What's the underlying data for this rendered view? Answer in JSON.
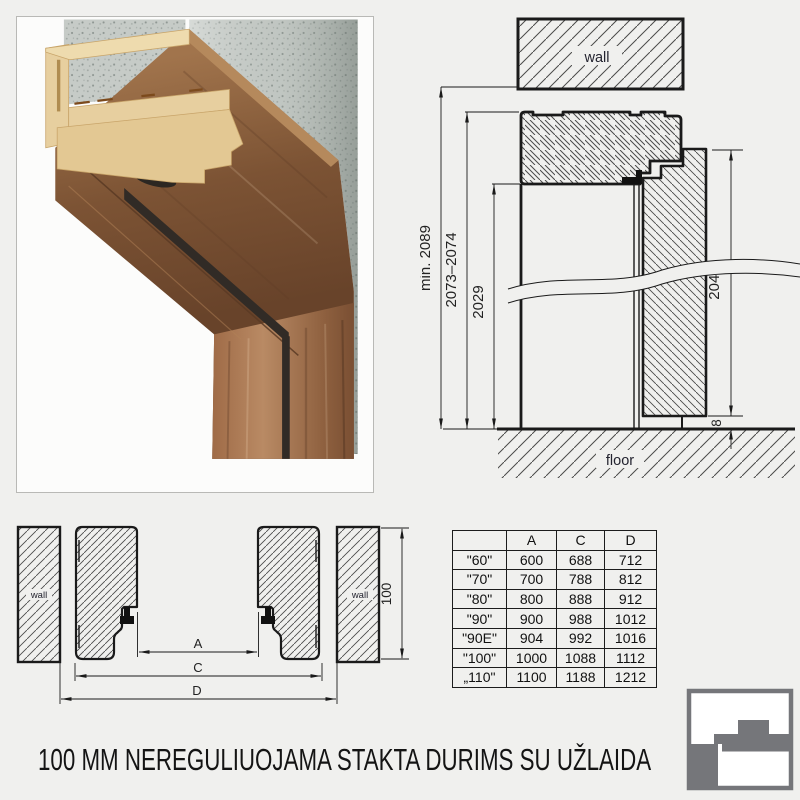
{
  "page": {
    "title": "100 MM NEREGULIUOJAMA STAKTA DURIMS SU UŽLAIDA",
    "background": "#f0f0ee"
  },
  "vertical_section": {
    "wall_label": "wall",
    "floor_label": "floor",
    "dims": {
      "min_total": "min. 2089",
      "frame_height": "2073–2074",
      "opening_height": "2029",
      "leaf_height": "2043",
      "floor_gap": "8"
    }
  },
  "horizontal_section": {
    "wall_left": "wall",
    "wall_right": "wall",
    "dims": {
      "a": "A",
      "c": "C",
      "d": "D",
      "depth": "100"
    }
  },
  "size_table": {
    "headers": [
      "",
      "A",
      "C",
      "D"
    ],
    "rows": [
      {
        "name": "\"60\"",
        "a": "600",
        "c": "688",
        "d": "712"
      },
      {
        "name": "\"70\"",
        "a": "700",
        "c": "788",
        "d": "812"
      },
      {
        "name": "\"80\"",
        "a": "800",
        "c": "888",
        "d": "912"
      },
      {
        "name": "\"90\"",
        "a": "900",
        "c": "988",
        "d": "1012"
      },
      {
        "name": "\"90E\"",
        "a": "904",
        "c": "992",
        "d": "1016"
      },
      {
        "name": "\"100\"",
        "a": "1000",
        "c": "1088",
        "d": "1112"
      },
      {
        "name": "„110\"",
        "a": "1100",
        "c": "1188",
        "d": "1212"
      }
    ]
  },
  "logo": {
    "meaning": "door-frame-profile-logo",
    "color": "#75767a"
  },
  "colors": {
    "line": "#1a1a1a",
    "hatch": "#4a4a4a",
    "wood": "#8a5f3e",
    "mdf": "#e7cf9f",
    "concrete": "#c6cbc7",
    "background": "#f0f0ee"
  }
}
